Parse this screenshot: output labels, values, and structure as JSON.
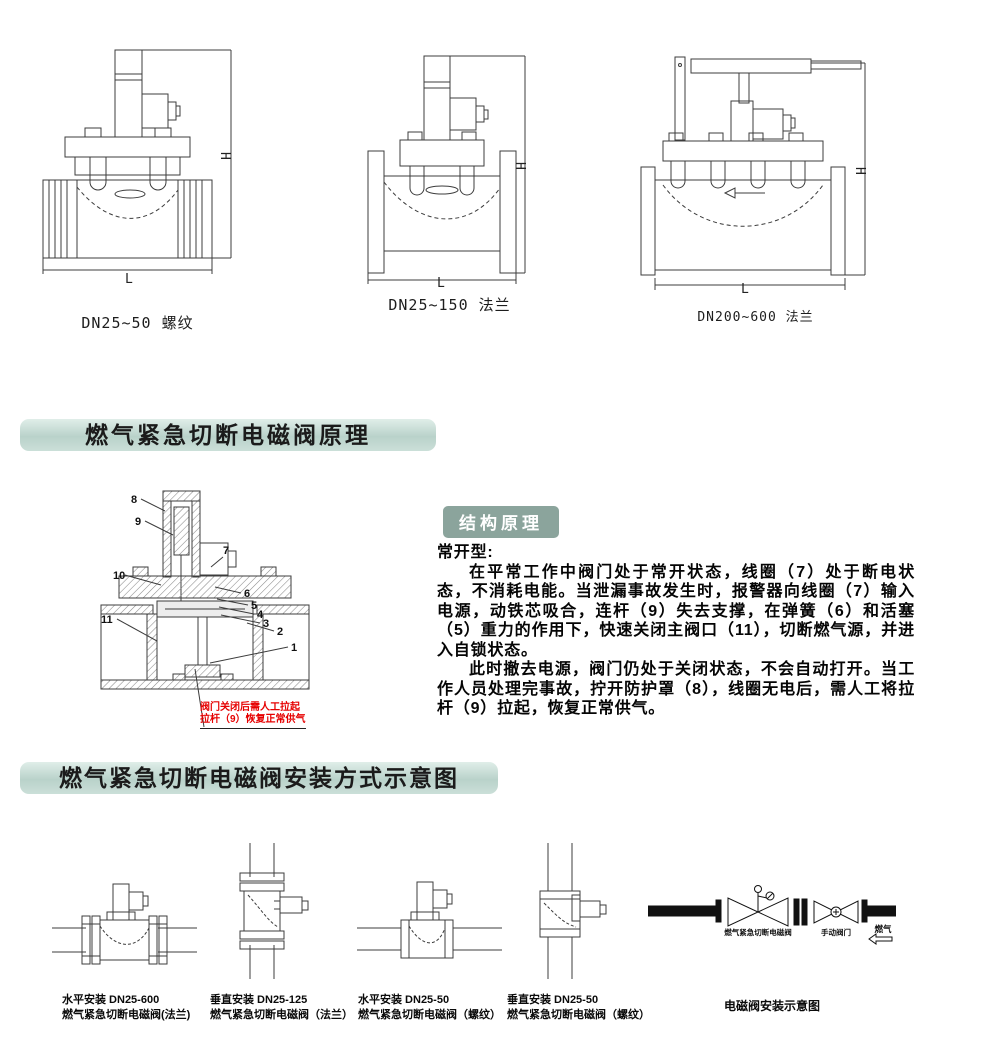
{
  "dims": {
    "h": "H",
    "l": "L"
  },
  "top_drawings": [
    {
      "caption": "DN25~50  螺纹"
    },
    {
      "caption": "DN25~150  法兰"
    },
    {
      "caption": "DN200~600  法兰"
    }
  ],
  "principle": {
    "title": "燃气紧急切断电磁阀原理",
    "badge": "结构原理",
    "type_heading": "常开型:",
    "para1": "在平常工作中阀门处于常开状态，线圈（7）处于断电状态，不消耗电能。当泄漏事故发生时，报警器向线圈（7）输入电源，动铁芯吸合，连杆（9）失去支撑，在弹簧（6）和活塞（5）重力的作用下，快速关闭主阀口（11），切断燃气源，并进入自锁状态。",
    "para2": "此时撤去电源，阀门仍处于关闭状态，不会自动打开。当工作人员处理完事故，拧开防护罩（8），线圈无电后，需人工将拉杆（9）拉起，恢复正常供气。",
    "parts": {
      "p1": "1",
      "p2": "2",
      "p3": "3",
      "p4": "4",
      "p5": "5",
      "p6": "6",
      "p7": "7",
      "p8": "8",
      "p9": "9",
      "p10": "10",
      "p11": "11"
    },
    "red_note": {
      "line1": "阀门关闭后需人工拉起",
      "line2": "拉杆（9）恢复正常供气"
    }
  },
  "install": {
    "title": "燃气紧急切断电磁阀安装方式示意图",
    "captions": [
      {
        "line1": "水平安装 DN25-600",
        "line2": "燃气紧急切断电磁阀(法兰)"
      },
      {
        "line1": "垂直安装 DN25-125",
        "line2": "燃气紧急切断电磁阀（法兰）"
      },
      {
        "line1": "水平安装 DN25-50",
        "line2": "燃气紧急切断电磁阀（螺纹）"
      },
      {
        "line1": "垂直安装 DN25-50",
        "line2": "燃气紧急切断电磁阀（螺纹）"
      }
    ],
    "schematic": {
      "valve_label": "燃气紧急切断电磁阀",
      "manual_valve_label": "手动阀门",
      "flow_label": "燃气",
      "caption": "电磁阀安装示意图"
    }
  },
  "colors": {
    "title_bar": "#b9d2ca",
    "badge": "#8ba49c",
    "red_note": "#e60000"
  }
}
